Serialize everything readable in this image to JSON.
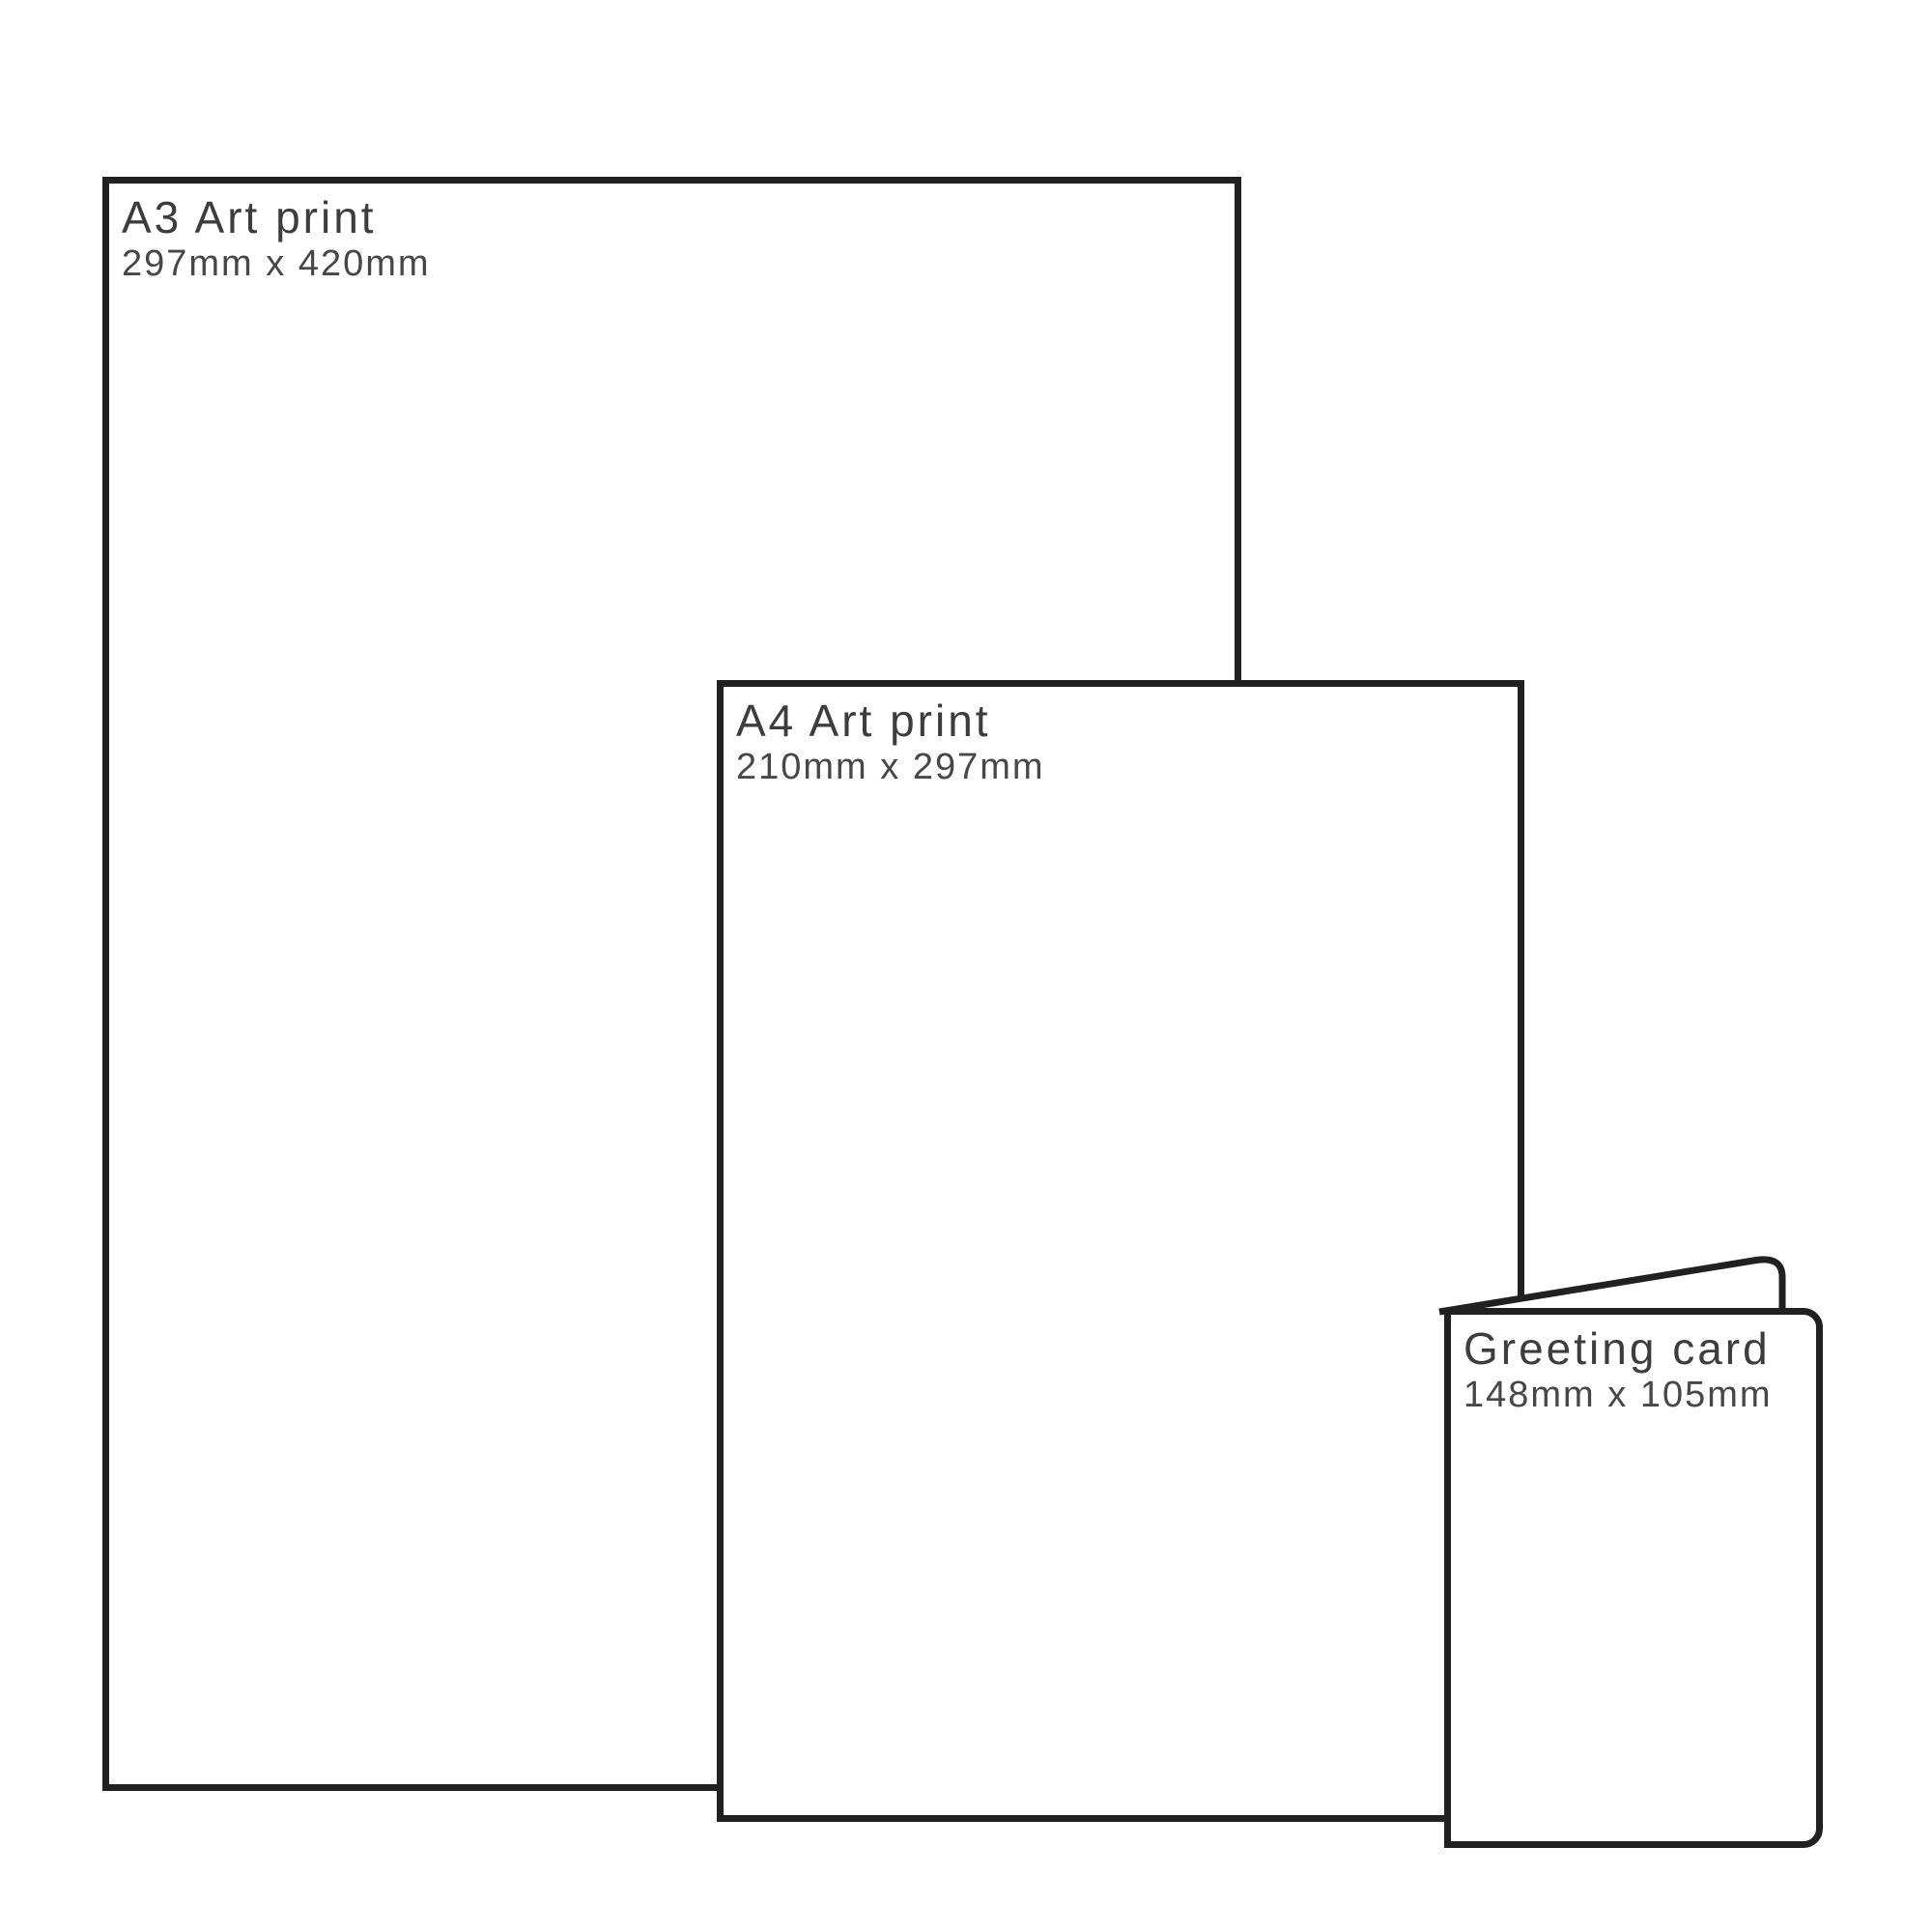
{
  "page": {
    "background": "#ffffff",
    "description": "Print size comparison diagram"
  },
  "colors": {
    "outline": "#212121",
    "title_text": "#3d3d3d",
    "dimensions_text": "#474747"
  },
  "products": [
    {
      "name": "a3-art-print",
      "title": "A3 Art print",
      "dimensions": "297mm x 420mm"
    },
    {
      "name": "a4-art-print",
      "title": "A4 Art print",
      "dimensions": "210mm x 297mm"
    },
    {
      "name": "greeting-card",
      "title": "Greeting card",
      "dimensions": "148mm x 105mm"
    }
  ]
}
